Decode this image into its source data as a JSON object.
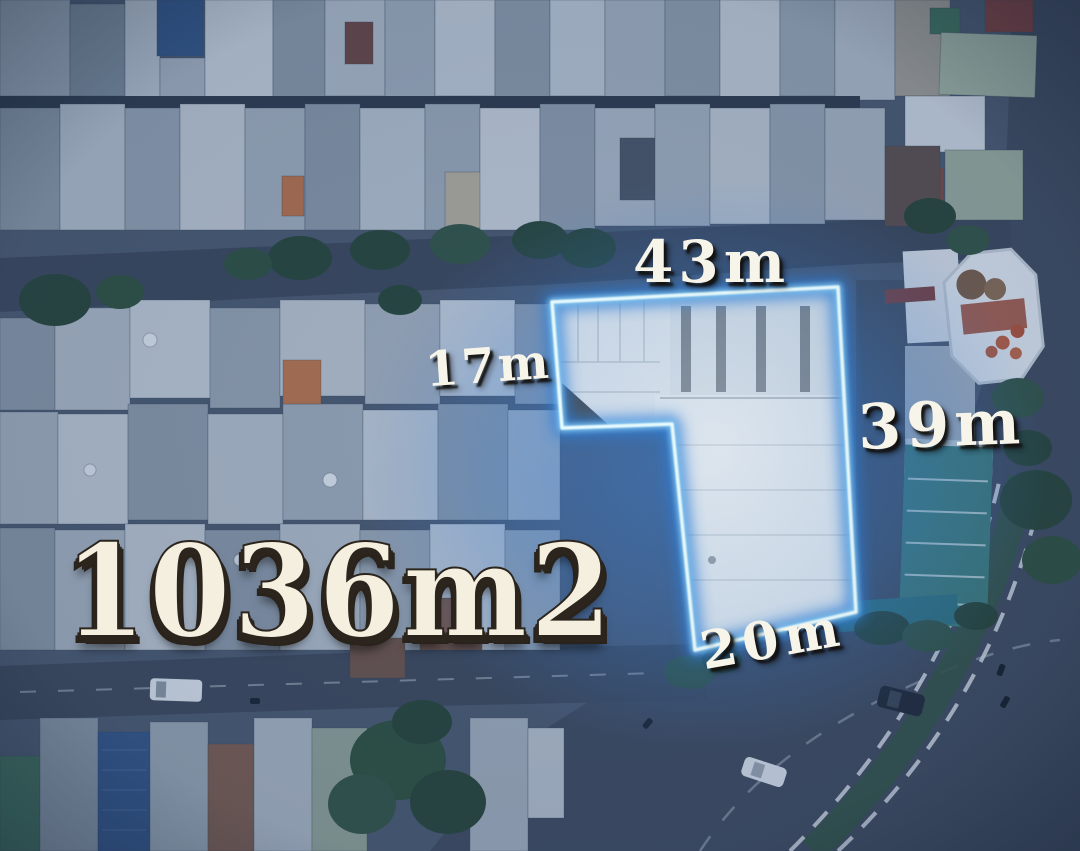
{
  "image": {
    "type": "aerial-drone-photo",
    "description": "Aerial drone view of a dense urban neighborhood at dusk with a land plot outlined by a glowing blue boundary, annotated with side dimensions and total area",
    "area_label": "1036m2",
    "dimensions": {
      "top": "43m",
      "left": "17m",
      "right": "39m",
      "bottom": "20m"
    },
    "colors": {
      "boundary_core": "#eafdff",
      "boundary_glow": "#2e7fd9",
      "dimension_text": "#f7f4ea",
      "area_text": "#f4efdf",
      "label_shadow": "#2b251d",
      "photo_tint": "#2b5ca0",
      "road": "#3f4754",
      "tree": "#26402c"
    }
  }
}
